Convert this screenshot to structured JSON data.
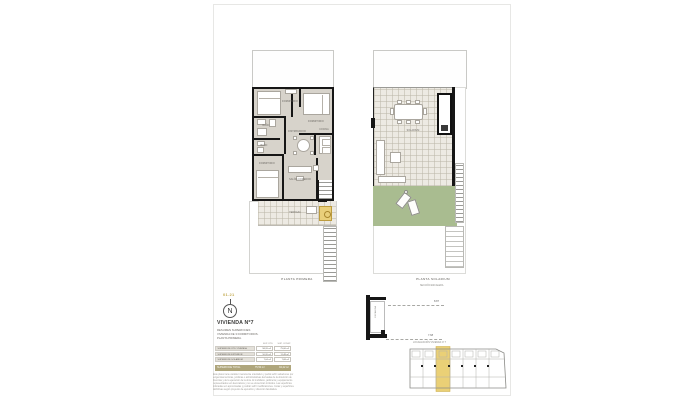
{
  "sheet": {
    "code": "01.21",
    "compass_letter": "N"
  },
  "title_block": {
    "title": "VIVIENDA Nº7",
    "subtitle_lines": [
      "RESUMEN SUPERFICIES",
      "VIVIENDA DE 3 DORMITORIOS.",
      "PLANTA PRIMERA."
    ],
    "table": {
      "col_headers": [
        "SUP. ÚTIL",
        "SUP. CONST."
      ],
      "rows": [
        {
          "label": "SUPERFICIE ÚTIL VIVIENDA",
          "util": "58,26 m²",
          "const": "75,06 m²"
        },
        {
          "label": "SUPERFICIE EXTERIOR",
          "util": "10,20 m²",
          "const": "11,48 m²"
        },
        {
          "label": "SUPERFICIE SOLARIUM",
          "util": "7,04 m²",
          "const": "7,68 m²"
        }
      ],
      "total": {
        "label": "SUPERFICIE TOTAL",
        "util": "75,50 m²",
        "const": "94,22 m²"
      }
    },
    "disclaimer_lines": [
      "Este plano tiene carácter meramente orientativo y podrá sufrir variaciones por",
      "exigencias técnicas, jurídicas o administrativas derivadas de la obtención de",
      "licencias y de la ejecución de la obra. El mobiliario, jardinería y equipamiento",
      "representados son decorativos y no se encuentran incluidos. Las superficies",
      "indicadas son aproximadas y podrán sufrir modificaciones. Cotas y superficies",
      "definitivas según proyecto de ejecución y dirección facultativa."
    ]
  },
  "plans": {
    "left": {
      "caption": "PLANTA PRIMERA",
      "rooms": [
        {
          "label": "DORMITORIO"
        },
        {
          "label": "DORMITORIO"
        },
        {
          "label": "BAÑO"
        },
        {
          "label": "BAÑO"
        },
        {
          "label": "DISTRIBUIDOR"
        },
        {
          "label": "COCINA"
        },
        {
          "label": "DORMITORIO"
        },
        {
          "label": "SALÓN-COMEDOR"
        },
        {
          "label": "TERRAZA"
        }
      ]
    },
    "right": {
      "caption": "PLANTA SOLARIUM",
      "rooms": [
        {
          "label": "SOLARIUM"
        }
      ]
    }
  },
  "section": {
    "note": "SECCIÓN ESCALERA",
    "vertical_label": "ESCALERA",
    "dim_top": "8.87",
    "dim_bottom": "7.68"
  },
  "key_plan": {
    "caption": "LOCALIZACIÓN VIVIENDA Nº 7"
  },
  "colors": {
    "floor": "#d7d3cb",
    "tile": "#edeae3",
    "grass": "#a9bc90",
    "highlight_yellow": "#e9cf7a",
    "total_bar": "#afa67c",
    "gold_code": "#c3aa50",
    "wall": "#161616"
  }
}
